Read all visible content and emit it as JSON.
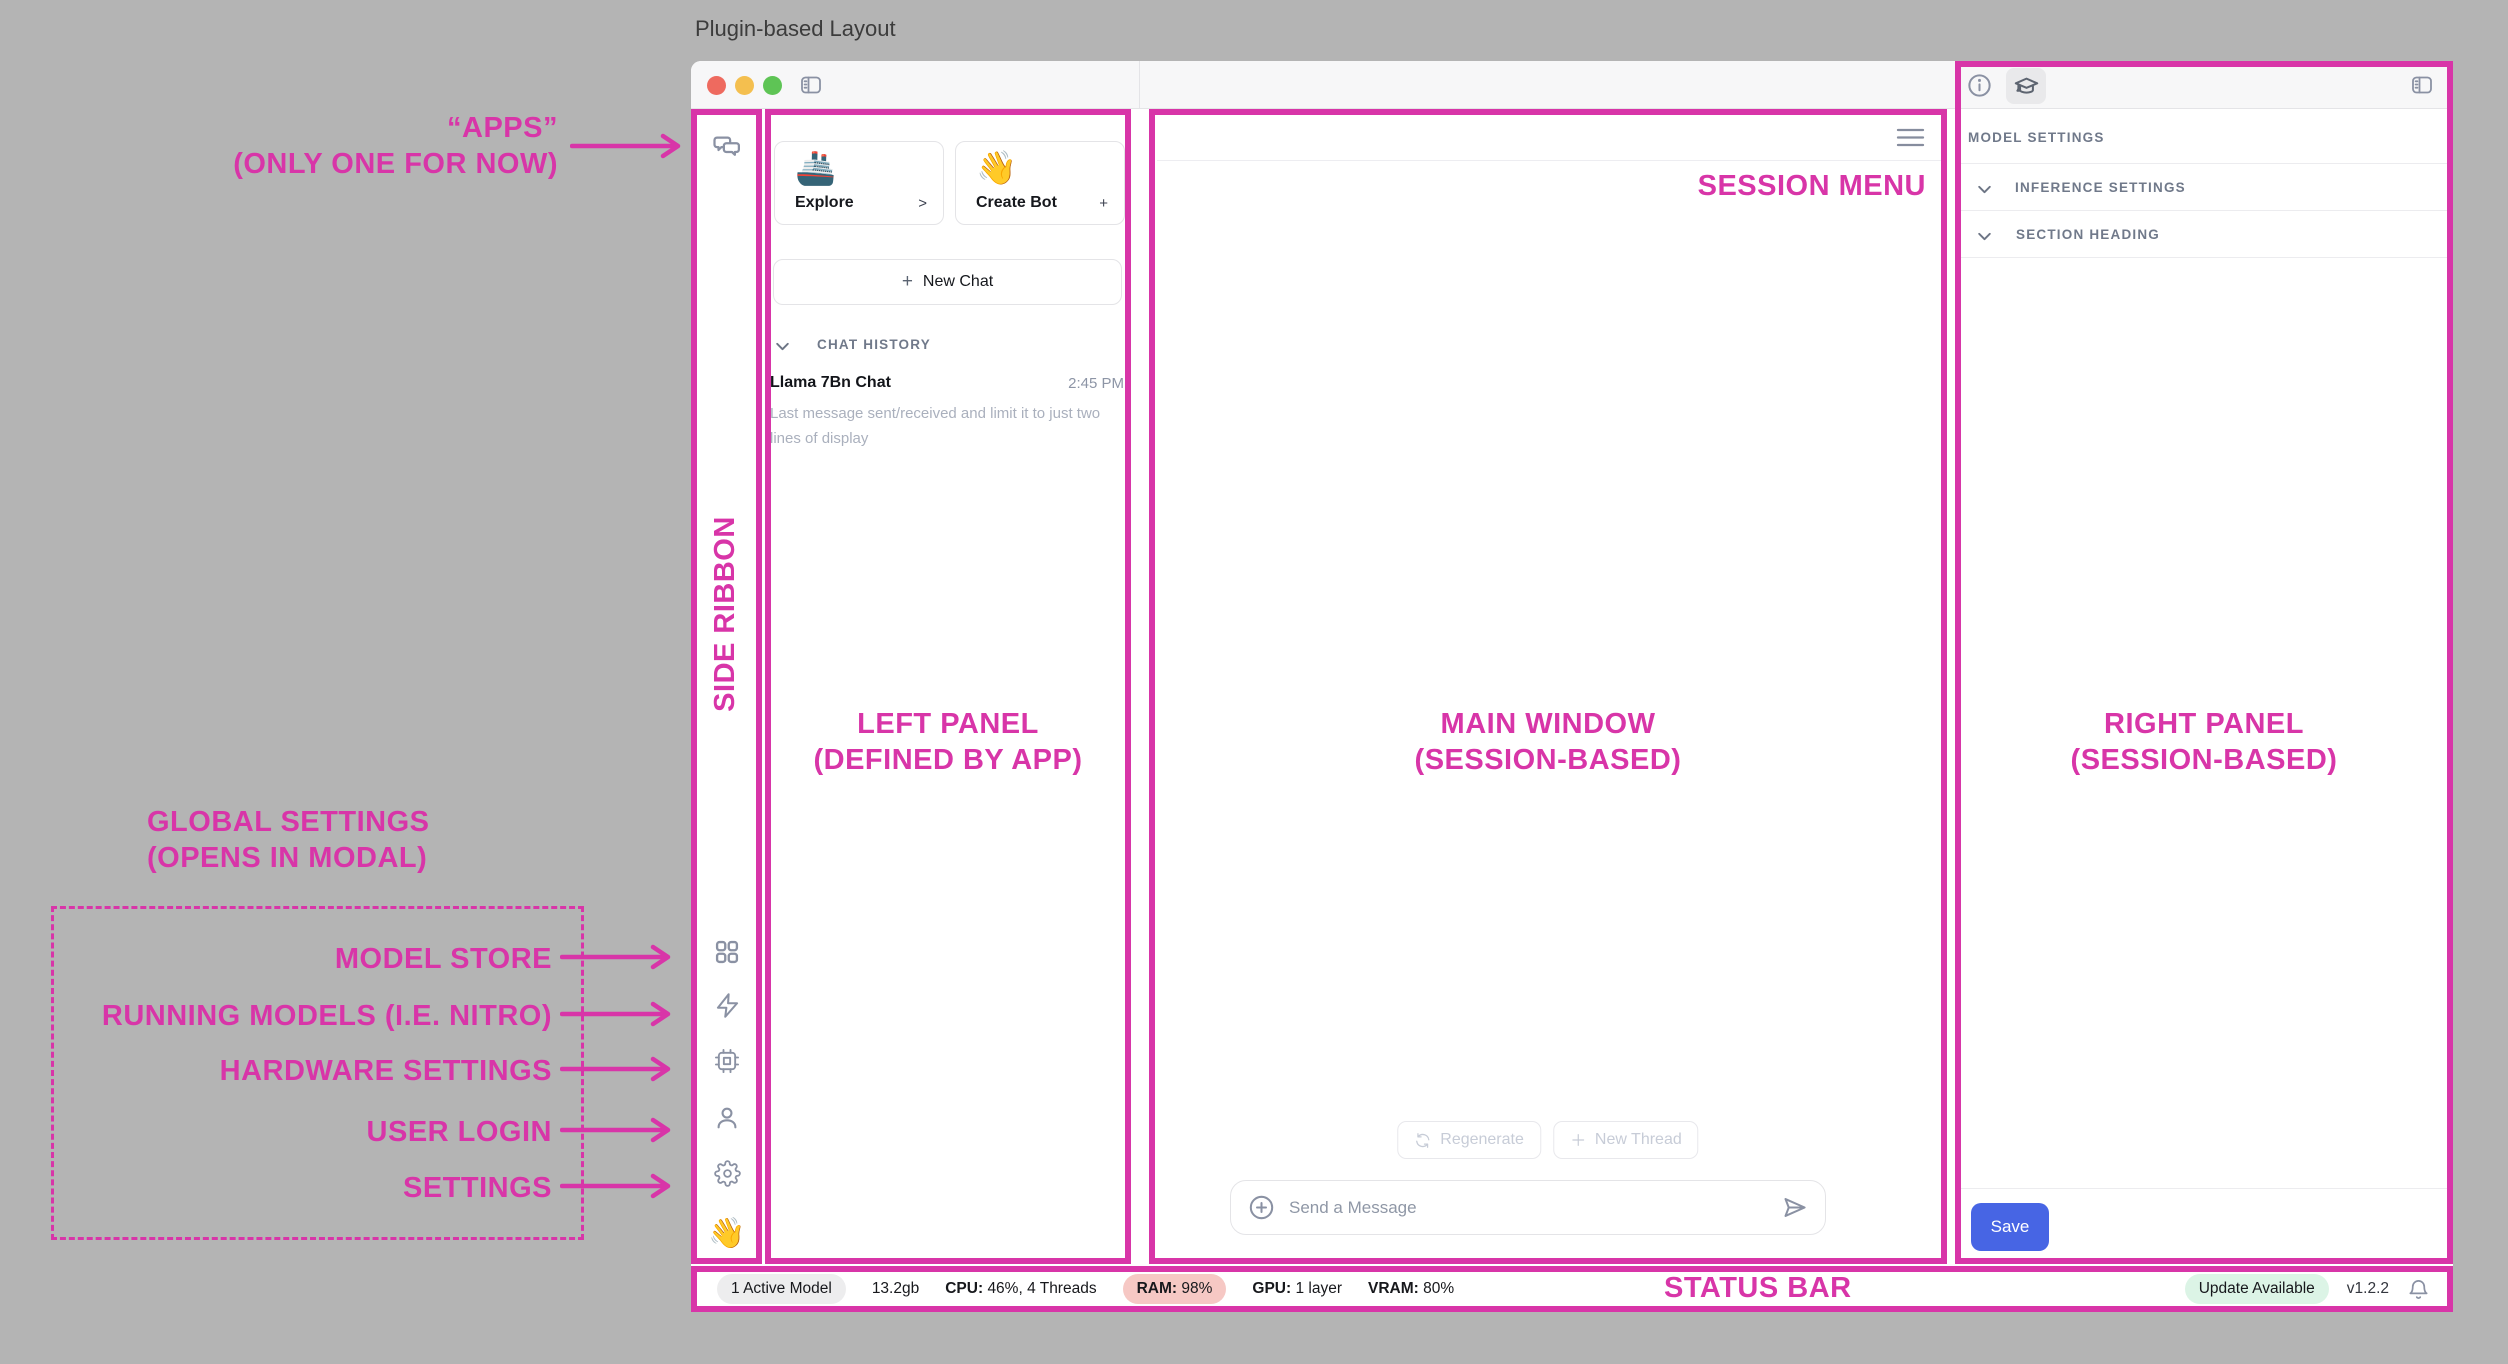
{
  "page": {
    "title": "Plugin-based Layout"
  },
  "colors": {
    "annotation_pink": "#d835a8",
    "save_blue": "#4765e4",
    "ram_badge_bg": "#f6c8c4",
    "update_badge_bg": "#dcf4e6",
    "active_badge_bg": "#ededee",
    "traffic_red": "#ee6a5f",
    "traffic_yellow": "#f4bf4f",
    "traffic_green": "#5ec455"
  },
  "annotations": {
    "apps_line1": "“APPS”",
    "apps_line2": "(ONLY ONE FOR NOW)",
    "side_ribbon": "SIDE RIBBON",
    "left_panel_line1": "LEFT PANEL",
    "left_panel_line2": "(DEFINED BY APP)",
    "main_window_line1": "MAIN WINDOW",
    "main_window_line2": "(SESSION-BASED)",
    "right_panel_line1": "RIGHT PANEL",
    "right_panel_line2": "(SESSION-BASED)",
    "session_menu": "SESSION MENU",
    "global_settings_line1": "GLOBAL SETTINGS",
    "global_settings_line2": "(OPENS IN MODAL)",
    "ribbon_targets": [
      "MODEL STORE",
      "RUNNING MODELS (I.E. NITRO)",
      "HARDWARE SETTINGS",
      "USER LOGIN",
      "SETTINGS"
    ],
    "status_bar": "STATUS BAR"
  },
  "ribbon": {
    "icons": [
      "chat-icon",
      "grid-icon",
      "zap-icon",
      "cpu-icon",
      "user-icon",
      "gear-icon"
    ],
    "wave_emoji": "👋"
  },
  "left_panel": {
    "cards": [
      {
        "emoji": "🚢",
        "label": "Explore",
        "action": ">"
      },
      {
        "emoji": "👋",
        "label": "Create Bot",
        "action": "+"
      }
    ],
    "new_chat_plus": "+",
    "new_chat_label": "New Chat",
    "history_header": "CHAT HISTORY",
    "items": [
      {
        "title": "Llama 7Bn Chat",
        "time": "2:45 PM",
        "preview": "Last message sent/received and limit it to just two lines of display"
      }
    ]
  },
  "main": {
    "regenerate_label": "Regenerate",
    "new_thread_label": "New Thread",
    "composer_placeholder": "Send a Message"
  },
  "right_panel": {
    "header": "MODEL SETTINGS",
    "sections": [
      "INFERENCE SETTINGS",
      "SECTION HEADING"
    ],
    "save_label": "Save"
  },
  "status_bar": {
    "active_models": "1 Active Model",
    "memory": "13.2gb",
    "cpu_label": "CPU:",
    "cpu_value": "46%, 4 Threads",
    "ram_label": "RAM:",
    "ram_value": "98%",
    "gpu_label": "GPU:",
    "gpu_value": "1 layer",
    "vram_label": "VRAM:",
    "vram_value": "80%",
    "update_badge": "Update Available",
    "version": "v1.2.2"
  }
}
